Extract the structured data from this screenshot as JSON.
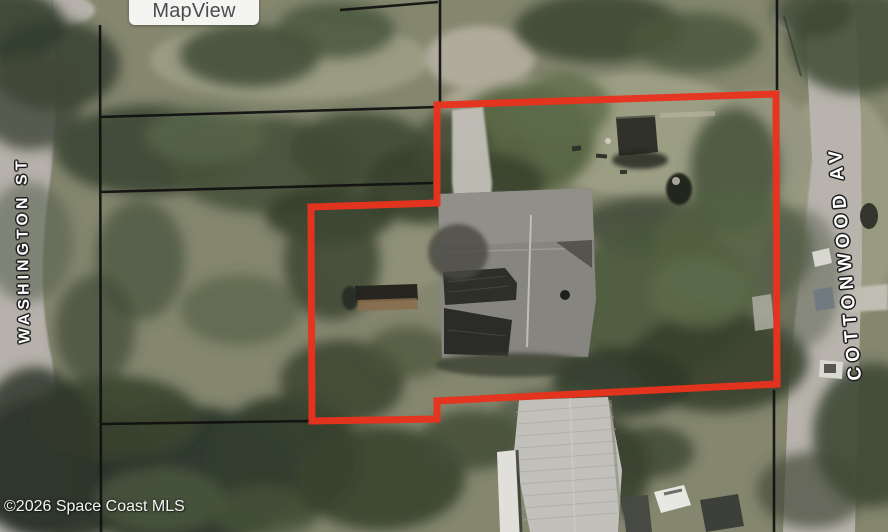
{
  "overlay": {
    "map_view_label": "MapView"
  },
  "streets": {
    "washington": "WASHINGTON ST",
    "cottonwood": "COTTONWOOD AV"
  },
  "footer": {
    "copyright": "©2026 Space Coast MLS"
  },
  "map": {
    "subject_parcel_outline_color": "#e7331e",
    "parcel_boundary_line_color": "#101010",
    "street_label_text_color": "#ffffff",
    "street_label_halo_color": "#1c1c1c"
  }
}
